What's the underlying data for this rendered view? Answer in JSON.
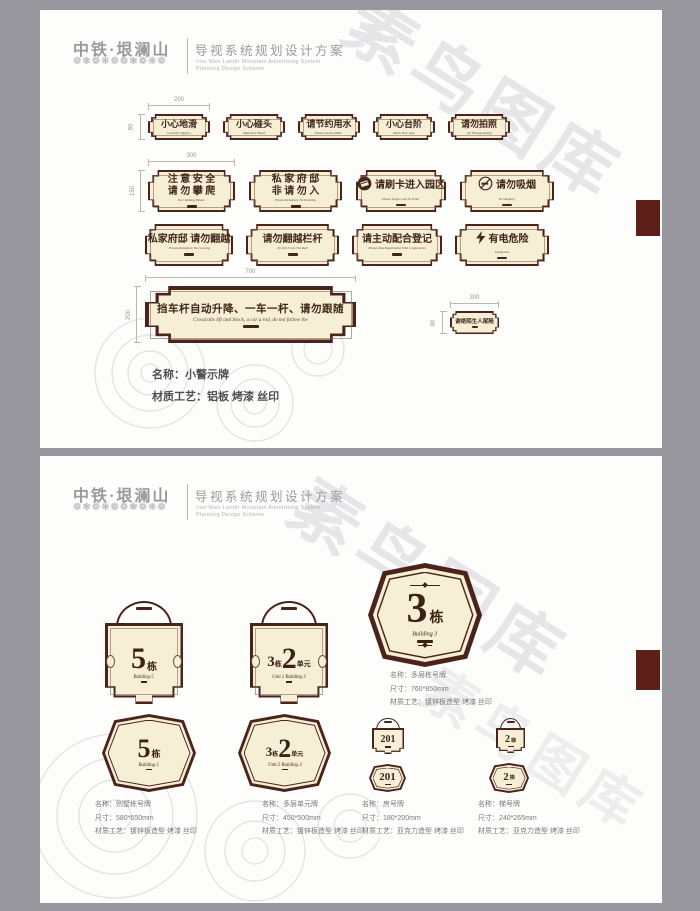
{
  "watermark_text": "素鸟图库",
  "header": {
    "logo_title": "中铁·垠澜山",
    "logo_ornament": "❁❃❁❋❁❁❃❁❋❁",
    "doc_title": "导视系统规划设计方案",
    "doc_sub_en1": "Iron Weir Landir Mountain Advertising System",
    "doc_sub_en2": "Planning Design Scheme"
  },
  "page1": {
    "dims": {
      "row1_w": "200",
      "row1_h": "80",
      "row2_w": "300",
      "row2_h": "150",
      "long_w": "700",
      "long_h": "200",
      "small_w": "300",
      "small_h": "80"
    },
    "row1": [
      {
        "lines": [
          "小心地滑"
        ],
        "sub": "Carefully Slippery"
      },
      {
        "lines": [
          "小心碰头"
        ],
        "sub": "Mind Your Head"
      },
      {
        "lines": [
          "请节约用水"
        ],
        "sub": "Please Saving Water"
      },
      {
        "lines": [
          "小心台阶"
        ],
        "sub": "Watch Your Step"
      },
      {
        "lines": [
          "请勿拍照"
        ],
        "sub": "No Photographing"
      }
    ],
    "row2": [
      {
        "lines": [
          "注 意 安 全",
          "请 勿 攀 爬"
        ],
        "sub": "No Climbing Please"
      },
      {
        "lines": [
          "私 家 府 邸",
          "非 请 勿 入"
        ],
        "sub": "Private Residence No Entering"
      },
      {
        "lines": [
          "请刷卡进入园区"
        ],
        "sub": "Please Swipe Card To Enter",
        "icon": "card"
      },
      {
        "lines": [
          "请勿吸烟"
        ],
        "sub": "No Smoking",
        "icon": "nosmoke"
      }
    ],
    "row3": [
      {
        "lines": [
          "私家府邸 请勿翻越"
        ],
        "sub": "Private Residence No Crossing"
      },
      {
        "lines": [
          "请勿翻越栏杆"
        ],
        "sub": "Do Not Cross The Rail"
      },
      {
        "lines": [
          "请主动配合登记"
        ],
        "sub": "Please Take Registration With Cooperation"
      },
      {
        "lines": [
          "有电危险"
        ],
        "sub": "Dangerous",
        "icon": "bolt"
      }
    ],
    "long_sign": {
      "text": "挡车杆自动升降、一车一杆、请勿跟随",
      "sub": "Crossrails lift and block, a car a rod, do not follow the"
    },
    "small_sign": {
      "text": "谢绝陌生人尾随"
    },
    "info": {
      "name": "名称：小警示牌",
      "craft": "材质工艺：铝板 烤漆 丝印"
    }
  },
  "page2": {
    "big_sign": {
      "num": "3",
      "suffix": "栋",
      "script": "Building 3"
    },
    "arch_signs": [
      {
        "num": "5",
        "suffix": "栋",
        "script": "Building 5"
      },
      {
        "pre_num": "3",
        "pre_suffix": "栋",
        "num": "2",
        "suffix": "单元",
        "script": "Unit 2 Building 3"
      }
    ],
    "hex_signs": [
      {
        "num": "5",
        "suffix": "栋",
        "script": "Building 5"
      },
      {
        "pre_num": "3",
        "pre_suffix": "栋",
        "num": "2",
        "suffix": "单元",
        "script": "Unit 2 Building 3"
      }
    ],
    "room_signs": [
      {
        "num": "201"
      },
      {
        "num": "201"
      }
    ],
    "stair_signs": [
      {
        "num": "2",
        "suffix": "梯"
      },
      {
        "num": "2",
        "suffix": "梯"
      }
    ],
    "info_big": {
      "name": "名称：多层栋号牌",
      "size": "尺寸：760*850mm",
      "craft": "材质工艺：镀锌板造型 烤漆 丝印"
    },
    "info_blocks": [
      {
        "name": "名称：别墅栋号牌",
        "size": "尺寸：580*650mm",
        "craft": "材质工艺：镀锌板造型 烤漆 丝印"
      },
      {
        "name": "名称：多层单元牌",
        "size": "尺寸：450*500mm",
        "craft": "材质工艺：镀锌板造型 烤漆 丝印"
      },
      {
        "name": "名称：房号牌",
        "size": "尺寸：180*200mm",
        "craft": "材质工艺：亚克力造型 烤漆 丝印"
      },
      {
        "name": "名称：梯号牌",
        "size": "尺寸：240*265mm",
        "craft": "材质工艺：亚克力造型 烤漆 丝印"
      }
    ]
  }
}
